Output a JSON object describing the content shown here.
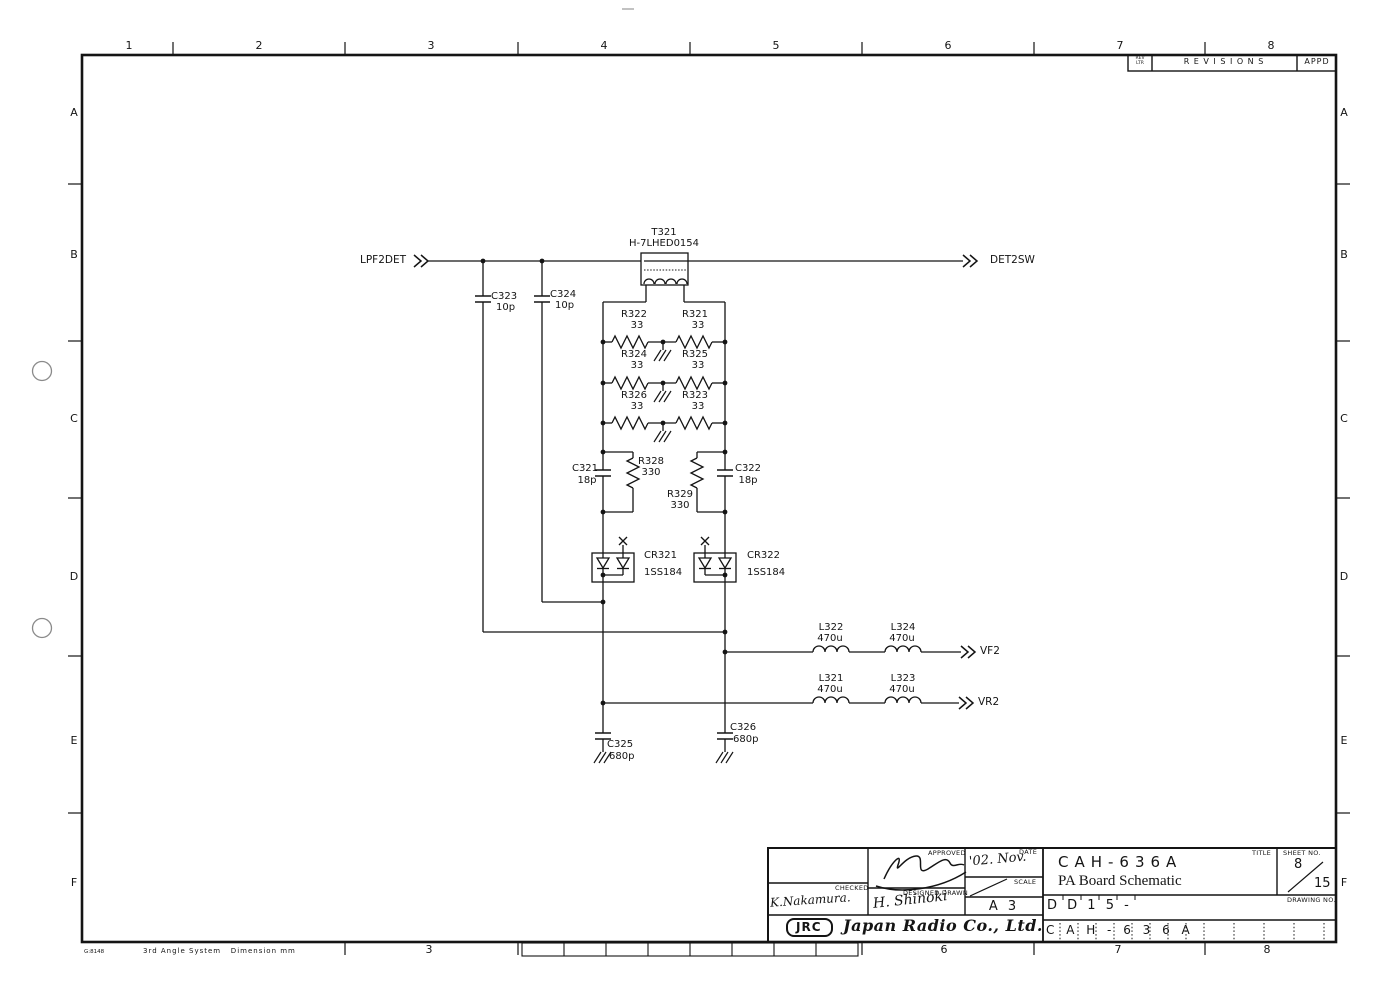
{
  "sheet": {
    "top_zones": [
      "1",
      "2",
      "3",
      "4",
      "5",
      "6",
      "7",
      "8"
    ],
    "bottom_zones": [
      "3",
      "6",
      "7",
      "8"
    ],
    "side_zones": [
      "A",
      "B",
      "C",
      "D",
      "E",
      "F"
    ],
    "footer_code": "G:8148",
    "footer_note": "3rd Angle System   Dimension mm"
  },
  "revisions": {
    "rev_ltr_top": "REV",
    "rev_ltr_bottom": "LTR",
    "heading": "R E V I S I O N S",
    "appd": "APPD"
  },
  "ports": {
    "lpf2det": "LPF2DET",
    "det2sw": "DET2SW",
    "vf2": "VF2",
    "vr2": "VR2"
  },
  "components": {
    "t321": {
      "ref": "T321",
      "part": "H-7LHED0154"
    },
    "c323": {
      "ref": "C323",
      "value": "10p"
    },
    "c324": {
      "ref": "C324",
      "value": "10p"
    },
    "r322": {
      "ref": "R322",
      "value": "33"
    },
    "r321": {
      "ref": "R321",
      "value": "33"
    },
    "r324": {
      "ref": "R324",
      "value": "33"
    },
    "r325": {
      "ref": "R325",
      "value": "33"
    },
    "r326": {
      "ref": "R326",
      "value": "33"
    },
    "r323": {
      "ref": "R323",
      "value": "33"
    },
    "c321": {
      "ref": "C321",
      "value": "18p"
    },
    "r328": {
      "ref": "R328",
      "value": "330"
    },
    "r329": {
      "ref": "R329",
      "value": "330"
    },
    "c322": {
      "ref": "C322",
      "value": "18p"
    },
    "cr321": {
      "ref": "CR321",
      "part": "1SS184"
    },
    "cr322": {
      "ref": "CR322",
      "part": "1SS184"
    },
    "l322": {
      "ref": "L322",
      "value": "470u"
    },
    "l324": {
      "ref": "L324",
      "value": "470u"
    },
    "l321": {
      "ref": "L321",
      "value": "470u"
    },
    "l323": {
      "ref": "L323",
      "value": "470u"
    },
    "c325": {
      "ref": "C325",
      "value": "680p"
    },
    "c326": {
      "ref": "C326",
      "value": "680p"
    }
  },
  "title_block": {
    "approved_label": "APPROVED",
    "checked_label": "CHECKED",
    "designed_drawn_label": "DESIGNED DRAWN",
    "date_label": "DATE",
    "scale_label": "SCALE",
    "checked_by": "K.Nakamura.",
    "designed_by": "H. Shinoki",
    "date_value": "'02. Nov.",
    "size": "A 3",
    "logo": "JRC",
    "company": "Japan Radio Co., Ltd.",
    "title_label": "TITLE",
    "model": "CAH-636A",
    "doc_title": "PA Board Schematic",
    "sheet_no_label": "SHEET NO.",
    "sheet_no": "8",
    "sheet_total": "15",
    "drawing_code": "D D 1 5 -",
    "drawing_no_label": "DRAWING NO.",
    "drawing_no": "C A H - 6 3 6 A"
  }
}
